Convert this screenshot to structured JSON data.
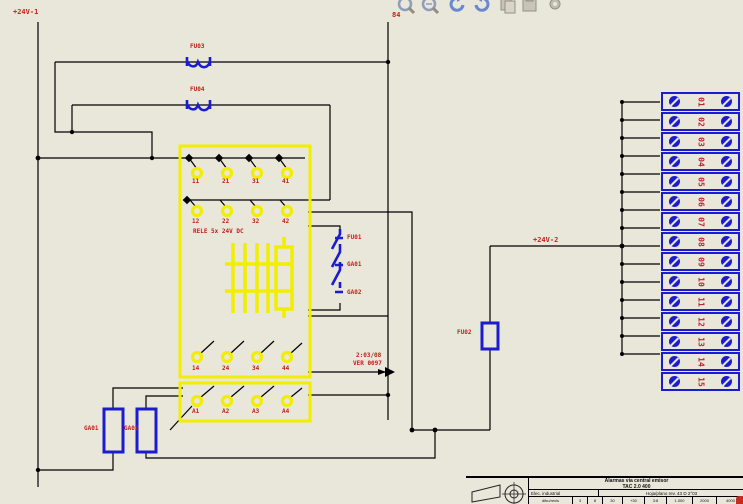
{
  "colors": {
    "background": "#e9e6da",
    "wire": "#000000",
    "symbol_yellow": "#f2ee00",
    "symbol_blue": "#1c1ccf",
    "label_red": "#c22018",
    "toolbar_grey": "#b2af9f",
    "toolbar_blue": "#6a88cf"
  },
  "toolbar": {
    "icons": [
      "zoom-out",
      "zoom-in",
      "undo",
      "redo",
      "copy",
      "paste",
      "properties"
    ]
  },
  "net_labels": {
    "supply_left": "+24V-1",
    "supply_mid": "+24V-2",
    "top_ref": "84",
    "xref_line1": "2:03/08",
    "xref_line2": "VER 0097"
  },
  "components": {
    "fuse_rail1": "FU03",
    "fuse_rail2": "FU04",
    "fuse_mid": "FU02",
    "chain": [
      "FU01",
      "GA01",
      "GA02"
    ],
    "resistor1": "GA01",
    "resistor2": "GA02",
    "relay_title": "RELE 5x 24V DC",
    "contacts_row1": [
      "11",
      "21",
      "31",
      "41"
    ],
    "contacts_row2": [
      "12",
      "22",
      "32",
      "42"
    ],
    "contacts_row3": [
      "14",
      "24",
      "34",
      "44"
    ],
    "contacts_row4": [
      "A1",
      "A2",
      "A3",
      "A4"
    ]
  },
  "terminals": {
    "list": [
      "01",
      "02",
      "03",
      "04",
      "05",
      "06",
      "07",
      "08",
      "09",
      "10",
      "11",
      "12",
      "13",
      "14",
      "15"
    ]
  },
  "title_block": {
    "title_line1": "Alarmas via central emisor",
    "title_line2": "TAC 2.0 400",
    "drawn_by": "Elec. industrial",
    "sheet_ref": "Hoja/plano rev. 43 D 2°03",
    "scale_cells": [
      "dibu/revis",
      "3",
      "8",
      "30",
      "+30",
      "3:8",
      "1.000",
      "2000",
      "4000"
    ]
  }
}
